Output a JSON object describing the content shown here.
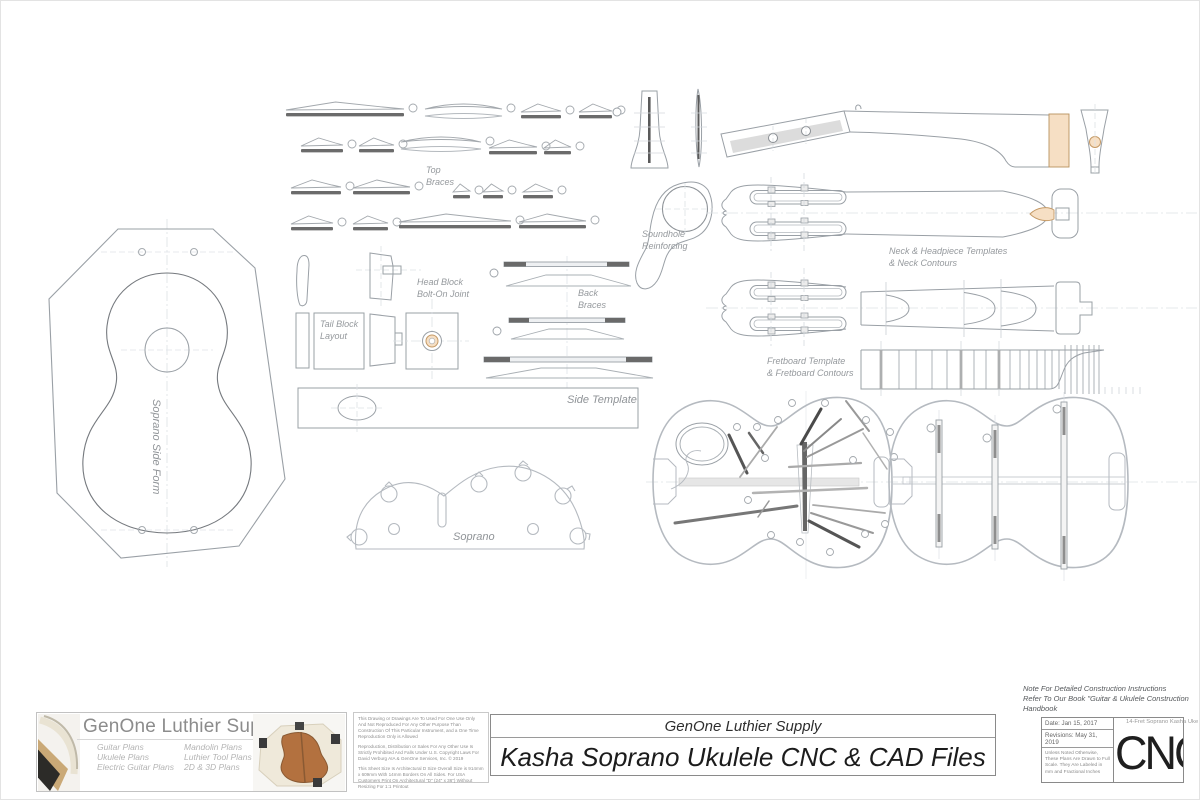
{
  "drawing": {
    "labels": {
      "top_braces_1": "Top",
      "top_braces_2": "Braces",
      "head_block_1": "Head Block",
      "head_block_2": "Bolt-On Joint",
      "tail_block_1": "Tail Block",
      "tail_block_2": "Layout",
      "back_braces_1": "Back",
      "back_braces_2": "Braces",
      "side_template": "Side Template",
      "soundhole_1": "Soundhole",
      "soundhole_2": "Reinforcing",
      "neck_templates_1": "Neck & Headpiece Templates",
      "neck_templates_2": "& Neck Contours",
      "fretboard_1": "Fretboard Template",
      "fretboard_2": "& Fretboard Contours",
      "soprano": "Soprano",
      "side_form": "Soprano Side Form"
    },
    "note_1": "Note For Detailed Construction Instructions",
    "note_2": "Refer To Our Book \"Guitar & Ukulele Construction",
    "note_3": "Handbook"
  },
  "title_block": {
    "brand": "GenOne Luthier Supplies",
    "plans_col1": [
      "Guitar Plans",
      "Ukulele Plans",
      "Electric Guitar Plans"
    ],
    "plans_col2": [
      "Mandolin Plans",
      "Luthier Tool Plans",
      "2D & 3D Plans"
    ],
    "legal_1": "This Drawing or Drawings Are To Used For One Use Only And Not Reproduced For Any Other Purpose Than Construction Of This Particular Instrument, and a One Time Reproduction Only is Allowed",
    "legal_2": "Reproduction, Distribution or Sales For Any Other Use Is Strictly Prohibited And Falls Under U.S. Copyright Laws For David Verburg AIA & GenOne Services, Inc. © 2019",
    "legal_3": "This Sheet Size Is Architectural D Size Overall Size is 914mm x 609mm With 14mm Borders On All Sides. For USA Customers Print On Architectural \"D\" (24\" x 36\") Without Resizing For 1:1 Printout",
    "company": "GenOne Luthier Supply",
    "title": "Kasha Soprano Ukulele CNC & CAD Files",
    "date": "Date: Jan 15, 2017",
    "revisions": "Revisions: May 31, 2019",
    "scale_note": "Unless Noted Otherwise, These Plans Are Drawn to Full Scale. They Are Labeled in mm and Fractional Inches",
    "sheet_name": "14-Fret Soprano Kasha Uke C",
    "logo": "CNC"
  }
}
